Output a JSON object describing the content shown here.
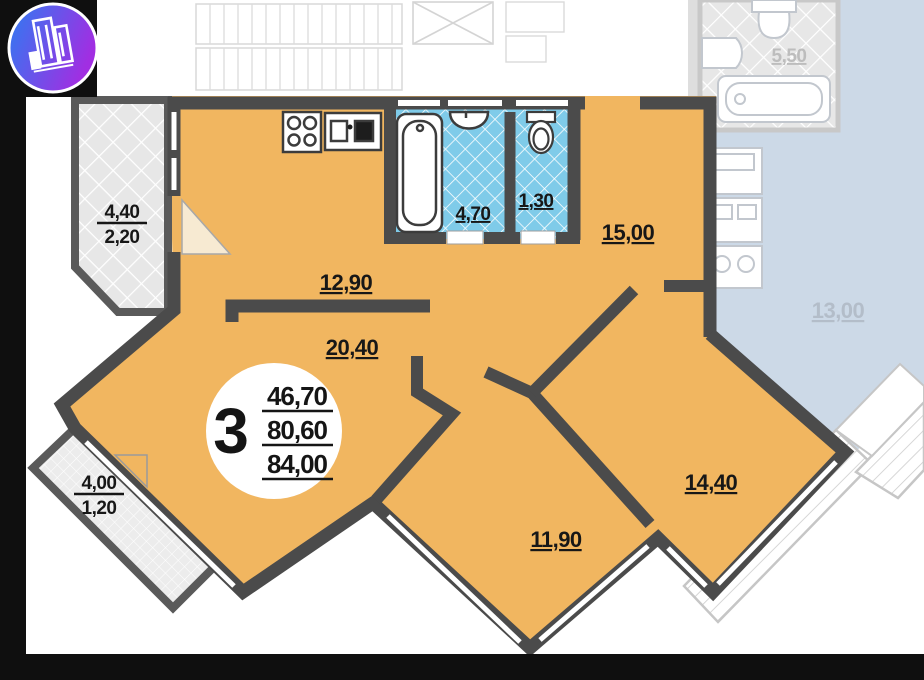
{
  "logo": {
    "name": "developer-building-logo"
  },
  "badge": {
    "rooms_count": "3",
    "areas": {
      "living": "46,70",
      "apartment": "80,60",
      "total": "84,00"
    }
  },
  "rooms": {
    "hall_kitchen": "12,90",
    "living_room": "20,40",
    "bedroom_top": "15,00",
    "bedroom_right": "14,40",
    "bedroom_bottom": "11,90",
    "bathroom": "4,70",
    "wc": "1,30"
  },
  "balconies": {
    "left": {
      "full": "4,40",
      "reduced": "2,20"
    },
    "bottom": {
      "full": "4,00",
      "reduced": "1,20"
    }
  },
  "neighbor": {
    "bathroom": "5,50",
    "kitchen": "13,00"
  },
  "colors": {
    "apartment_fill": "#f1b660",
    "walls": "#4b4b4b",
    "wet_room_tile": "#7fcbe9",
    "neighbor_unit": "#ccd9e7",
    "frame": "#0f0f0f",
    "logo_gradient_start": "#2d7cf2",
    "logo_gradient_end": "#a12ee2"
  }
}
